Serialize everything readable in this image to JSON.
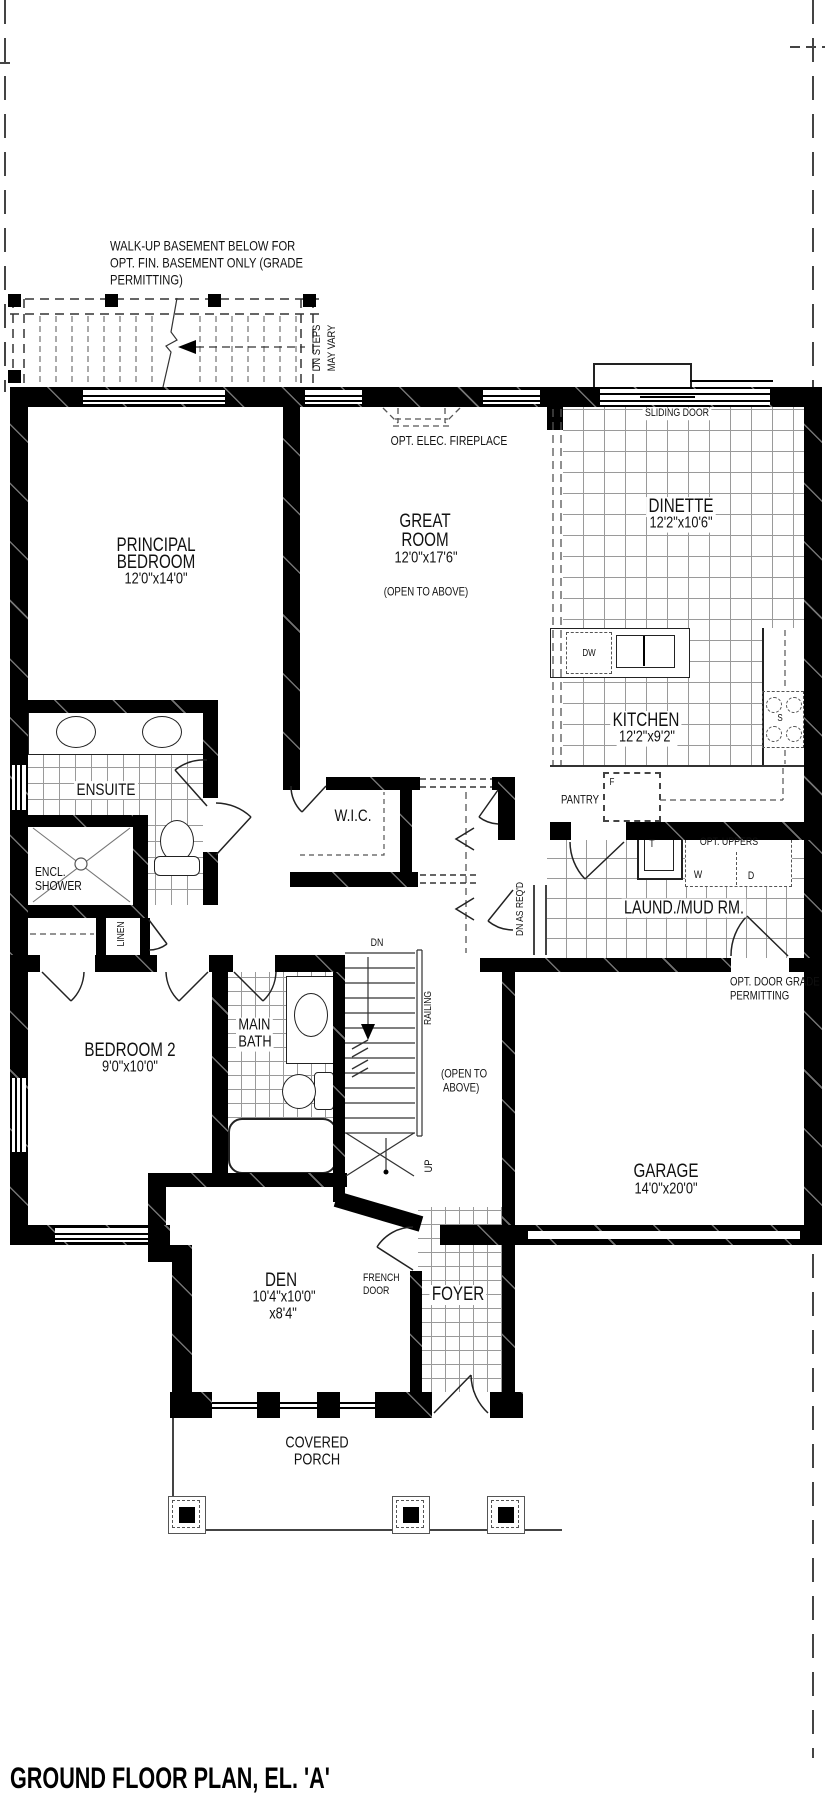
{
  "title": "GROUND FLOOR PLAN, EL. 'A'",
  "colors": {
    "wall": "#000000",
    "linework": "#333333",
    "tile_line": "#9a9a9a",
    "paper": "#ffffff"
  },
  "walkup_note": {
    "line1": "WALK-UP BASEMENT BELOW FOR",
    "line2": "OPT. FIN. BASEMENT ONLY (GRADE",
    "line3": "PERMITTING)",
    "dn_steps": "DN STEPS",
    "may_vary": "MAY VARY"
  },
  "rooms": {
    "principal": {
      "name1": "PRINCIPAL",
      "name2": "BEDROOM",
      "dims": "12'0\"x14'0\""
    },
    "great": {
      "name1": "GREAT",
      "name2": "ROOM",
      "dims": "12'0\"x17'6\"",
      "open": "(OPEN TO ABOVE)"
    },
    "dinette": {
      "name": "DINETTE",
      "dims": "12'2\"x10'6\""
    },
    "kitchen": {
      "name": "KITCHEN",
      "dims": "12'2\"x9'2\""
    },
    "ensuite": {
      "name": "ENSUITE"
    },
    "shower": {
      "name1": "ENCL.",
      "name2": "SHOWER"
    },
    "wic": {
      "name": "W.I.C."
    },
    "pantry": {
      "name": "PANTRY"
    },
    "laundry": {
      "name": "LAUND./MUD RM."
    },
    "bedroom2": {
      "name": "BEDROOM 2",
      "dims": "9'0\"x10'0\""
    },
    "mainbath": {
      "name1": "MAIN",
      "name2": "BATH"
    },
    "garage": {
      "name": "GARAGE",
      "dims": "14'0\"x20'0\""
    },
    "den": {
      "name": "DEN",
      "dims1": "10'4\"x10'0\"",
      "dims2": "x8'4\""
    },
    "foyer": {
      "name": "FOYER"
    },
    "porch": {
      "name1": "COVERED",
      "name2": "PORCH"
    }
  },
  "annotations": {
    "sliding_door": "SLIDING DOOR",
    "fireplace": "OPT. ELEC. FIREPLACE",
    "open_above1": "(OPEN TO",
    "open_above2": "ABOVE)",
    "french1": "FRENCH",
    "french2": "DOOR",
    "opt_door1": "OPT. DOOR GRADE",
    "opt_door2": "PERMITTING",
    "opt_uppers": "OPT. UPPERS",
    "dn_as_reqd": "DN AS REQ'D",
    "linen": "LINEN",
    "railing": "RAILING",
    "dn": "DN",
    "up": "UP",
    "dw": "DW",
    "fridge": "F",
    "tub": "T",
    "stove": "S",
    "washer": "W",
    "dryer": "D"
  }
}
